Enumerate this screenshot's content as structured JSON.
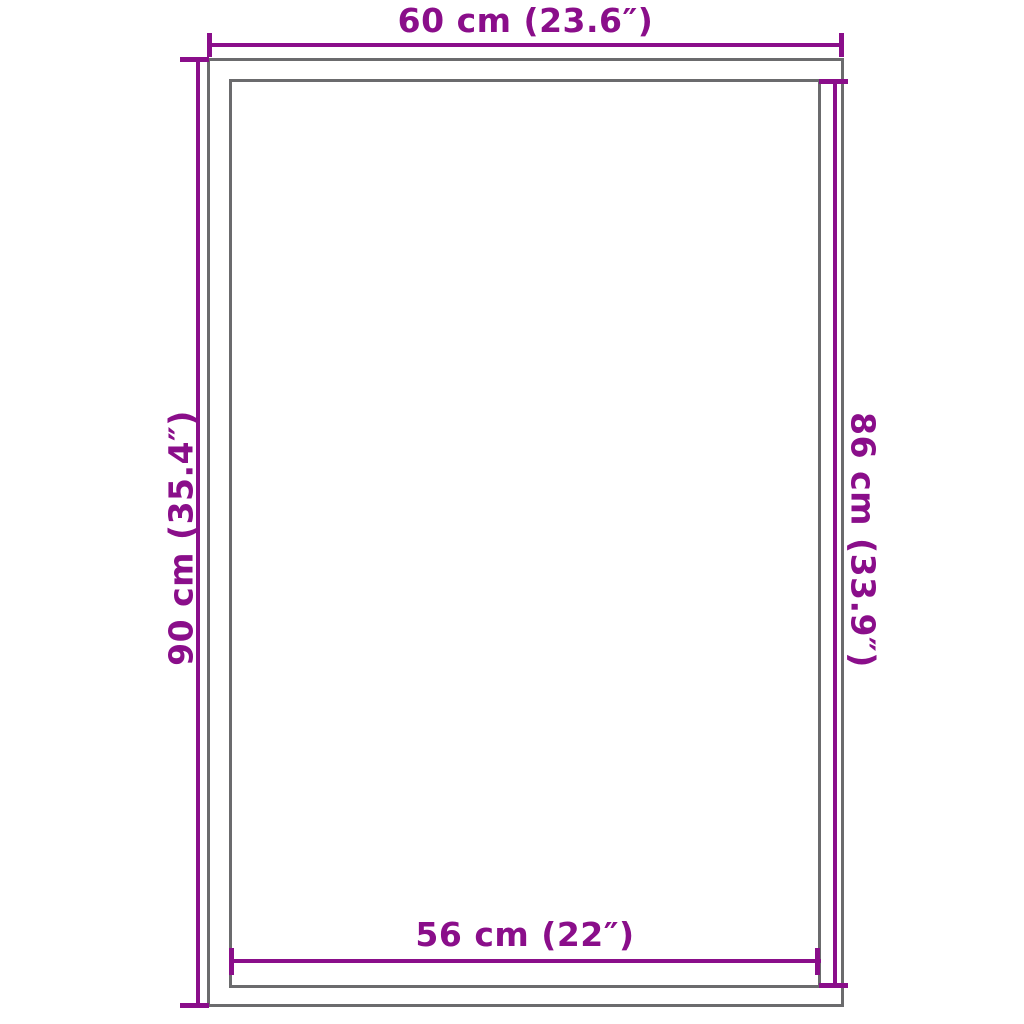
{
  "diagram": {
    "type": "product-dimension-diagram",
    "top_dimension": "60 cm (23.6″)",
    "left_dimension": "90 cm (35.4″)",
    "right_dimension": "86 cm (33.9″)",
    "bottom_dimension": "56 cm (22″)",
    "dimensions": {
      "outer_width_cm": 60,
      "outer_width_in": 23.6,
      "outer_height_cm": 90,
      "outer_height_in": 35.4,
      "inner_height_cm": 86,
      "inner_height_in": 33.9,
      "inner_width_cm": 56,
      "inner_width_in": 22
    },
    "colors": {
      "dimension_line": "#8a0e8a",
      "outline": "#6b6b6d",
      "background": "#ffffff"
    }
  }
}
